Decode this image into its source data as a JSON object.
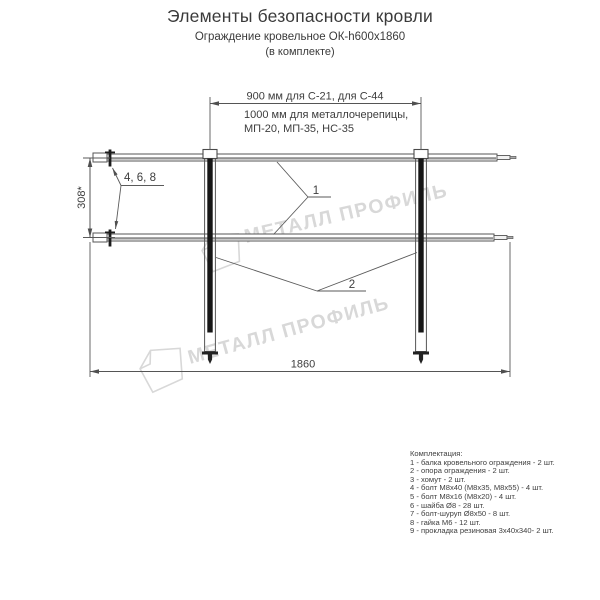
{
  "header": {
    "title": "Элементы безопасности кровли",
    "subtitle": "Ограждение кровельное ОК-h600х1860",
    "note": "(в комплекте)"
  },
  "diagram": {
    "dim_top_line1": "900 мм для С-21, для С-44",
    "dim_top_line2": "1000 мм для металлочерепицы,",
    "dim_top_line3": "МП-20, МП-35, НС-35",
    "dim_height": "308*",
    "dim_width": "1860",
    "label_fasteners": "4, 6, 8",
    "label_beam": "1",
    "label_post": "2"
  },
  "watermark": {
    "text": "МЕТАЛЛ ПРОФИЛЬ",
    "color": "#d8d8d8"
  },
  "colors": {
    "line": "#555555",
    "post": "#1c1c1c",
    "text": "#3a3a3a",
    "watermark": "#d8d8d8"
  },
  "parts": {
    "heading": "Комплектация:",
    "items": [
      "1 - балка кровельного ограждения - 2 шт.",
      "2 - опора ограждения - 2 шт.",
      "3 - хомут - 2 шт.",
      "4 - болт М8х40 (М8х35, М8х55) - 4 шт.",
      "5 - болт М8х16 (М8х20) - 4 шт.",
      "6 - шайба Ø8 - 28 шт.",
      "7 - болт-шуруп Ø8х50 - 8 шт.",
      "8 - гайка М6 - 12 шт.",
      "9 - прокладка резиновая 3х40х340- 2 шт."
    ]
  }
}
